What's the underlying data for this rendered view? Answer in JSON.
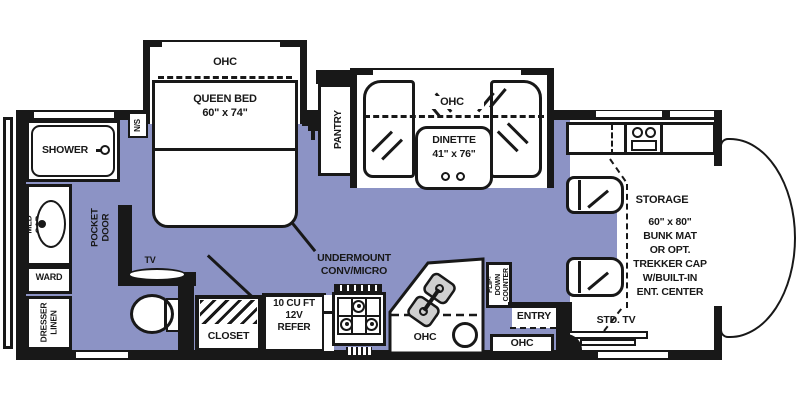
{
  "colors": {
    "floor": "#8c93c5",
    "wall": "#181818",
    "sink_basin": "#cfcfcf"
  },
  "bedroom": {
    "ohc": "OHC",
    "bed": "QUEEN BED\n60\" x 74\"",
    "nightstand": "N/S",
    "tv": "TV",
    "pocket_door": "POCKET DOOR"
  },
  "bathroom": {
    "shower": "SHOWER",
    "med_cab": "MED CAB",
    "ward": "WARD",
    "dresser_linen": "DRESSER\nLINEN"
  },
  "kitchen": {
    "pantry": "PANTRY",
    "undermount": "UNDERMOUNT\nCONV/MICRO",
    "refer": "10 CU FT\n12V\nREFER",
    "closet": "CLOSET",
    "ohc": "OHC",
    "flip_down": "FLIP-DOWN\nCOUNTER"
  },
  "dinette": {
    "ohc": "OHC",
    "label": "DINETTE\n41\" x 76\""
  },
  "entry": {
    "label": "ENTRY",
    "ohc": "OHC"
  },
  "cab": {
    "storage": "STORAGE",
    "bunk": "60\" x 80\"\nBUNK MAT\nOR OPT.\nTREKKER CAP\nW/BUILT-IN\nENT. CENTER",
    "std_tv": "STD. TV"
  }
}
